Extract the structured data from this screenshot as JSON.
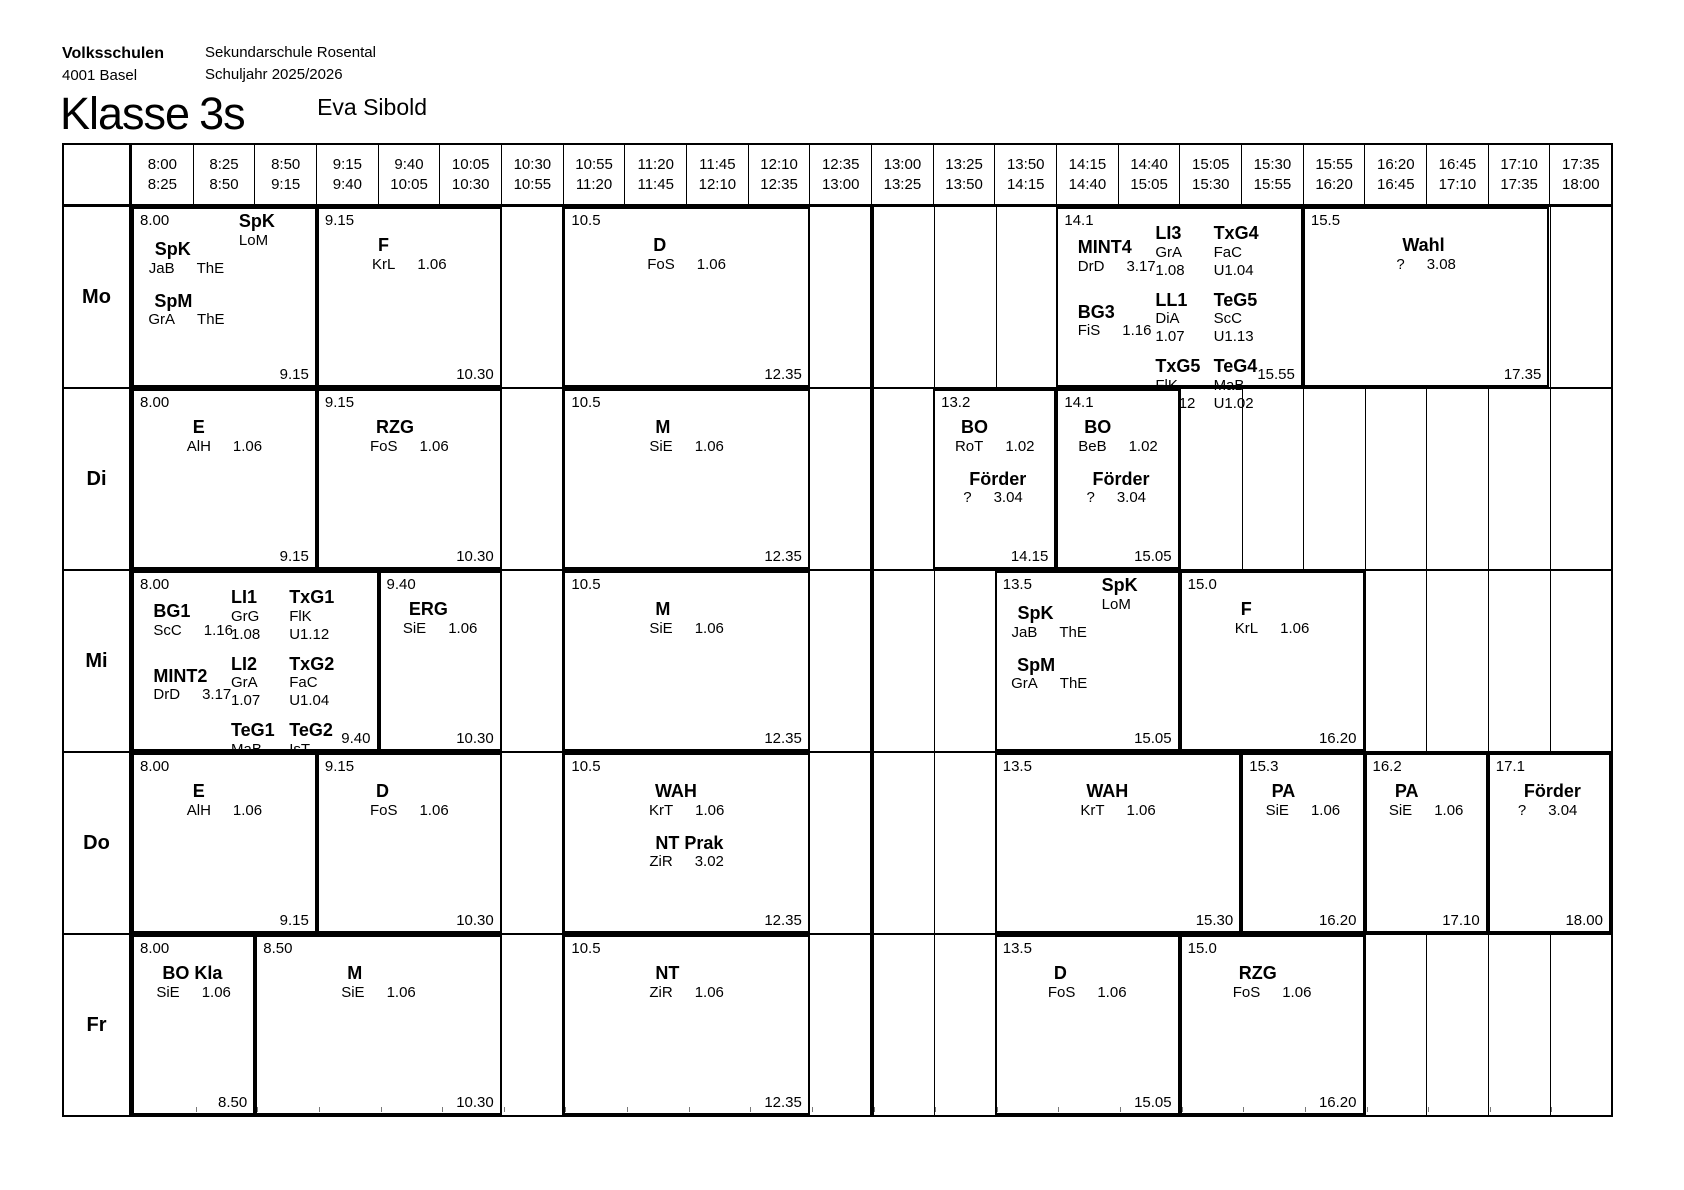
{
  "page": {
    "org_name": "Volksschulen",
    "org_city": "4001 Basel",
    "school": "Sekundarschule Rosental",
    "school_year": "Schuljahr 2025/2026",
    "title_label": "Klasse",
    "title_value": "3s",
    "class_teacher": "Eva Sibold"
  },
  "timetable": {
    "midday_divider_after": "13:00",
    "time_columns": [
      {
        "start": "8:00",
        "end": "8:25"
      },
      {
        "start": "8:25",
        "end": "8:50"
      },
      {
        "start": "8:50",
        "end": "9:15"
      },
      {
        "start": "9:15",
        "end": "9:40"
      },
      {
        "start": "9:40",
        "end": "10:05"
      },
      {
        "start": "10:05",
        "end": "10:30"
      },
      {
        "start": "10:30",
        "end": "10:55"
      },
      {
        "start": "10:55",
        "end": "11:20"
      },
      {
        "start": "11:20",
        "end": "11:45"
      },
      {
        "start": "11:45",
        "end": "12:10"
      },
      {
        "start": "12:10",
        "end": "12:35"
      },
      {
        "start": "12:35",
        "end": "13:00"
      },
      {
        "start": "13:00",
        "end": "13:25"
      },
      {
        "start": "13:25",
        "end": "13:50"
      },
      {
        "start": "13:50",
        "end": "14:15"
      },
      {
        "start": "14:15",
        "end": "14:40"
      },
      {
        "start": "14:40",
        "end": "15:05"
      },
      {
        "start": "15:05",
        "end": "15:30"
      },
      {
        "start": "15:30",
        "end": "15:55"
      },
      {
        "start": "15:55",
        "end": "16:20"
      },
      {
        "start": "16:20",
        "end": "16:45"
      },
      {
        "start": "16:45",
        "end": "17:10"
      },
      {
        "start": "17:10",
        "end": "17:35"
      },
      {
        "start": "17:35",
        "end": "18:00"
      }
    ],
    "days": [
      {
        "label": "Mo",
        "blocks": [
          {
            "slot": 0,
            "span": 3,
            "start": "8.00",
            "end": "9.15",
            "corner": {
              "title": "SpK",
              "lines": [
                "LoM"
              ]
            },
            "entries": [
              {
                "title": "SpK",
                "detail": [
                  "JaB",
                  "ThE"
                ]
              },
              {
                "title": "SpM",
                "detail": [
                  "GrA",
                  "ThE"
                ]
              }
            ]
          },
          {
            "slot": 3,
            "span": 3,
            "start": "9.15",
            "end": "10.30",
            "entries": [
              {
                "title": "F",
                "detail": [
                  "KrL",
                  "1.06"
                ]
              }
            ]
          },
          {
            "slot": 7,
            "span": 4,
            "start": "10.5",
            "end": "12.35",
            "entries": [
              {
                "title": "D",
                "detail": [
                  "FoS",
                  "1.06"
                ]
              }
            ]
          },
          {
            "slot": 15,
            "span": 4,
            "start": "14.1",
            "end": "15.55",
            "kind": "triple",
            "columns": [
              {
                "entries": [
                  {
                    "title": "MINT4",
                    "detail": [
                      "DrD",
                      "3.17"
                    ]
                  },
                  {
                    "title": "BG3",
                    "detail": [
                      "FiS",
                      "1.16"
                    ]
                  }
                ]
              },
              {
                "entries": [
                  {
                    "title": "LI3",
                    "stack": [
                      "GrA",
                      "1.08"
                    ]
                  },
                  {
                    "title": "LL1",
                    "stack": [
                      "DiA",
                      "1.07"
                    ]
                  },
                  {
                    "title": "TxG5",
                    "stack": [
                      "FlK",
                      "U1.12"
                    ]
                  }
                ]
              },
              {
                "entries": [
                  {
                    "title": "TxG4",
                    "stack": [
                      "FaC",
                      "U1.04"
                    ]
                  },
                  {
                    "title": "TeG5",
                    "stack": [
                      "ScC",
                      "U1.13"
                    ]
                  },
                  {
                    "title": "TeG4",
                    "stack": [
                      "MaB",
                      "U1.02"
                    ]
                  }
                ]
              }
            ]
          },
          {
            "slot": 19,
            "span": 4,
            "start": "15.5",
            "end": "17.35",
            "entries": [
              {
                "title": "Wahl",
                "detail": [
                  "?",
                  "3.08"
                ]
              }
            ]
          }
        ]
      },
      {
        "label": "Di",
        "blocks": [
          {
            "slot": 0,
            "span": 3,
            "start": "8.00",
            "end": "9.15",
            "entries": [
              {
                "title": "E",
                "detail": [
                  "AlH",
                  "1.06"
                ]
              }
            ]
          },
          {
            "slot": 3,
            "span": 3,
            "start": "9.15",
            "end": "10.30",
            "entries": [
              {
                "title": "RZG",
                "detail": [
                  "FoS",
                  "1.06"
                ]
              }
            ]
          },
          {
            "slot": 7,
            "span": 4,
            "start": "10.5",
            "end": "12.35",
            "entries": [
              {
                "title": "M",
                "detail": [
                  "SiE",
                  "1.06"
                ]
              }
            ]
          },
          {
            "slot": 13,
            "span": 2,
            "start": "13.2",
            "end": "14.15",
            "entries": [
              {
                "title": "BO",
                "detail": [
                  "RoT",
                  "1.02"
                ]
              },
              {
                "title": "Förder",
                "detail": [
                  "?",
                  "3.04"
                ]
              }
            ]
          },
          {
            "slot": 15,
            "span": 2,
            "start": "14.1",
            "end": "15.05",
            "entries": [
              {
                "title": "BO",
                "detail": [
                  "BeB",
                  "1.02"
                ]
              },
              {
                "title": "Förder",
                "detail": [
                  "?",
                  "3.04"
                ]
              }
            ]
          }
        ]
      },
      {
        "label": "Mi",
        "blocks": [
          {
            "slot": 0,
            "span": 4,
            "start": "8.00",
            "end": "9.40",
            "kind": "triple",
            "columns": [
              {
                "entries": [
                  {
                    "title": "BG1",
                    "detail": [
                      "ScC",
                      "1.16"
                    ]
                  },
                  {
                    "title": "MINT2",
                    "detail": [
                      "DrD",
                      "3.17"
                    ]
                  }
                ]
              },
              {
                "entries": [
                  {
                    "title": "LI1",
                    "stack": [
                      "GrG",
                      "1.08"
                    ]
                  },
                  {
                    "title": "LI2",
                    "stack": [
                      "GrA",
                      "1.07"
                    ]
                  },
                  {
                    "title": "TeG1",
                    "stack": [
                      "MaB",
                      "U1.02"
                    ]
                  }
                ]
              },
              {
                "entries": [
                  {
                    "title": "TxG1",
                    "stack": [
                      "FlK",
                      "U1.12"
                    ]
                  },
                  {
                    "title": "TxG2",
                    "stack": [
                      "FaC",
                      "U1.04"
                    ]
                  },
                  {
                    "title": "TeG2",
                    "stack": [
                      "IsT",
                      "U1.13"
                    ]
                  }
                ]
              }
            ]
          },
          {
            "slot": 4,
            "span": 2,
            "start": "9.40",
            "end": "10.30",
            "entries": [
              {
                "title": "ERG",
                "detail": [
                  "SiE",
                  "1.06"
                ]
              }
            ]
          },
          {
            "slot": 7,
            "span": 4,
            "start": "10.5",
            "end": "12.35",
            "entries": [
              {
                "title": "M",
                "detail": [
                  "SiE",
                  "1.06"
                ]
              }
            ]
          },
          {
            "slot": 14,
            "span": 3,
            "start": "13.5",
            "end": "15.05",
            "corner": {
              "title": "SpK",
              "lines": [
                "LoM"
              ]
            },
            "entries": [
              {
                "title": "SpK",
                "detail": [
                  "JaB",
                  "ThE"
                ]
              },
              {
                "title": "SpM",
                "detail": [
                  "GrA",
                  "ThE"
                ]
              }
            ]
          },
          {
            "slot": 17,
            "span": 3,
            "start": "15.0",
            "end": "16.20",
            "entries": [
              {
                "title": "F",
                "detail": [
                  "KrL",
                  "1.06"
                ]
              }
            ]
          }
        ]
      },
      {
        "label": "Do",
        "blocks": [
          {
            "slot": 0,
            "span": 3,
            "start": "8.00",
            "end": "9.15",
            "entries": [
              {
                "title": "E",
                "detail": [
                  "AlH",
                  "1.06"
                ]
              }
            ]
          },
          {
            "slot": 3,
            "span": 3,
            "start": "9.15",
            "end": "10.30",
            "entries": [
              {
                "title": "D",
                "detail": [
                  "FoS",
                  "1.06"
                ]
              }
            ]
          },
          {
            "slot": 7,
            "span": 4,
            "start": "10.5",
            "end": "12.35",
            "entries": [
              {
                "title": "WAH",
                "detail": [
                  "KrT",
                  "1.06"
                ]
              },
              {
                "title": "NT Prak",
                "detail": [
                  "ZiR",
                  "3.02"
                ]
              }
            ]
          },
          {
            "slot": 14,
            "span": 4,
            "start": "13.5",
            "end": "15.30",
            "entries": [
              {
                "title": "WAH",
                "detail": [
                  "KrT",
                  "1.06"
                ]
              }
            ]
          },
          {
            "slot": 18,
            "span": 2,
            "start": "15.3",
            "end": "16.20",
            "entries": [
              {
                "title": "PA",
                "detail": [
                  "SiE",
                  "1.06"
                ]
              }
            ]
          },
          {
            "slot": 20,
            "span": 2,
            "start": "16.2",
            "end": "17.10",
            "entries": [
              {
                "title": "PA",
                "detail": [
                  "SiE",
                  "1.06"
                ]
              }
            ]
          },
          {
            "slot": 22,
            "span": 2,
            "start": "17.1",
            "end": "18.00",
            "entries": [
              {
                "title": "Förder",
                "detail": [
                  "?",
                  "3.04"
                ]
              }
            ]
          }
        ]
      },
      {
        "label": "Fr",
        "blocks": [
          {
            "slot": 0,
            "span": 2,
            "start": "8.00",
            "end": "8.50",
            "entries": [
              {
                "title": "BO Kla",
                "detail": [
                  "SiE",
                  "1.06"
                ]
              }
            ]
          },
          {
            "slot": 2,
            "span": 4,
            "start": "8.50",
            "end": "10.30",
            "entries": [
              {
                "title": "M",
                "detail": [
                  "SiE",
                  "1.06"
                ]
              }
            ]
          },
          {
            "slot": 7,
            "span": 4,
            "start": "10.5",
            "end": "12.35",
            "entries": [
              {
                "title": "NT",
                "detail": [
                  "ZiR",
                  "1.06"
                ]
              }
            ]
          },
          {
            "slot": 14,
            "span": 3,
            "start": "13.5",
            "end": "15.05",
            "entries": [
              {
                "title": "D",
                "detail": [
                  "FoS",
                  "1.06"
                ]
              }
            ]
          },
          {
            "slot": 17,
            "span": 3,
            "start": "15.0",
            "end": "16.20",
            "entries": [
              {
                "title": "RZG",
                "detail": [
                  "FoS",
                  "1.06"
                ]
              }
            ]
          }
        ]
      }
    ]
  }
}
